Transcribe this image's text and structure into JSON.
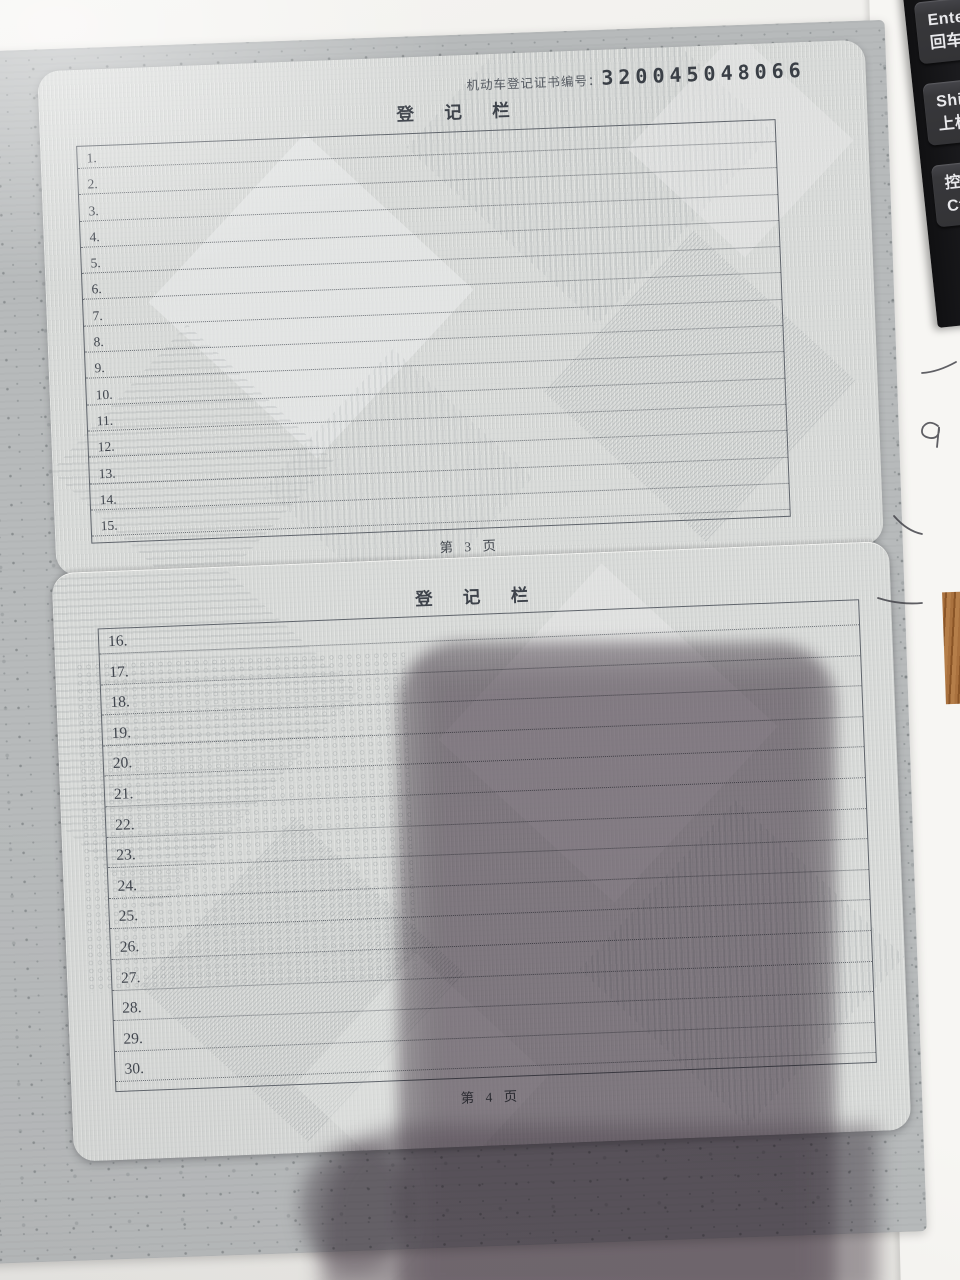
{
  "photo": {
    "description": "Photograph of a Chinese motor vehicle registration certificate lying open on a desk, phone shadow over lower half, keyboard edge at right"
  },
  "document": {
    "serial_label": "机动车登记证书编号：",
    "serial_number": "320045048066",
    "pages": [
      {
        "title": "登 记 栏",
        "rows": [
          "1.",
          "2.",
          "3.",
          "4.",
          "5.",
          "6.",
          "7.",
          "8.",
          "9.",
          "10.",
          "11.",
          "12.",
          "13.",
          "14.",
          "15."
        ],
        "footer": "第 3 页"
      },
      {
        "title": "登 记 栏",
        "rows": [
          "16.",
          "17.",
          "18.",
          "19.",
          "20.",
          "21.",
          "22.",
          "23.",
          "24.",
          "25.",
          "26.",
          "27.",
          "28.",
          "29.",
          "30."
        ],
        "footer": "第 4 页"
      }
    ]
  },
  "keyboard": {
    "keys": [
      {
        "line1": "Enter",
        "line2": "回车"
      },
      {
        "line1": "Shift",
        "line2": "上档"
      },
      {
        "line1": "控制",
        "line2": "Ctrl"
      }
    ]
  },
  "colors": {
    "cover_gray": "#b7babb",
    "page_gray": "#d7d9d7",
    "ink": "#40454d",
    "shadow": "#60546080",
    "key_face": "#38383b",
    "wood": "#a9713e"
  }
}
